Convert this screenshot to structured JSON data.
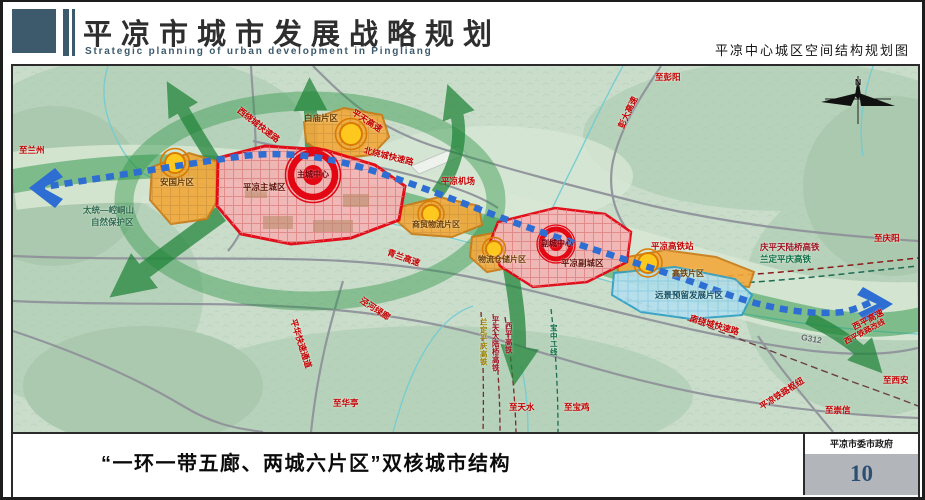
{
  "header": {
    "title_cn": "平凉市城市发展战略规划",
    "title_en": "Strategic planning of urban development in Pingliang",
    "map_title": "平凉中心城区空间结构规划图"
  },
  "map": {
    "compass": "N",
    "zones": {
      "anguo": "安国片区",
      "baimiao": "白庙片区",
      "main_city": "平凉主城区",
      "main_center": "主城中心",
      "shangmao": "商贸物流片区",
      "wuliu": "物流仓储片区",
      "sub_city": "平凉副城区",
      "sub_center": "副城中心",
      "gaotie": "高铁片区",
      "reserve": "远景预留发展片区"
    },
    "labels": {
      "to_lanzhou": "至兰州",
      "nature_reserve_1": "太统—崆峒山",
      "nature_reserve_2": "自然保护区",
      "west_ring": "西绕城快速路",
      "pingtian_expwy": "平天高速",
      "north_ring": "北绕城快速路",
      "airport": "平凉机场",
      "pengda_expwy": "彭大高速",
      "to_pengyang": "至彭阳",
      "qinglan_expwy": "青兰高速",
      "green_corridor": "泾河绿廊",
      "pinghua_expwy": "平华快速通道",
      "to_huating": "至华亭",
      "landing_hsr_v": "兰定平庆高铁",
      "pingtian_bridge_hsr_v": "平天大陆桥高铁",
      "xiping_hsr_v": "西平高铁",
      "baozhong_line_v": "宝中二线",
      "to_tianshui": "至天水",
      "to_baoji": "至宝鸡",
      "hsr_station": "平凉高铁站",
      "qingping_hsr": "庆平天陆桥高铁",
      "landing_hsr": "兰定平庆高铁",
      "to_qingyang": "至庆阳",
      "south_ring": "南绕城快速路",
      "g312": "G312",
      "xiping_expwy": "西平高速",
      "xiping_rail_reroute": "西平铁路改线",
      "to_xian": "至西安",
      "rail_hub": "平凉铁路枢纽",
      "to_chongxin": "至崇信"
    }
  },
  "footer": {
    "caption": "“一环一带五廊、两城六片区”双核城市结构",
    "org": "平凉市委市政府",
    "page": "10"
  },
  "colors": {
    "header_accent": "#3d5a6c",
    "zone_border_red": "#e30613",
    "zone_fill_pink": "#f3b6b6",
    "zone_fill_orange": "#f2a93c",
    "node_yellow": "#ffc81e",
    "corridor_green": "#2a9345",
    "transit_blue": "#2e6ed2",
    "reserve_blue": "#b5e0ee",
    "page_number_blue": "#2e4f74"
  }
}
